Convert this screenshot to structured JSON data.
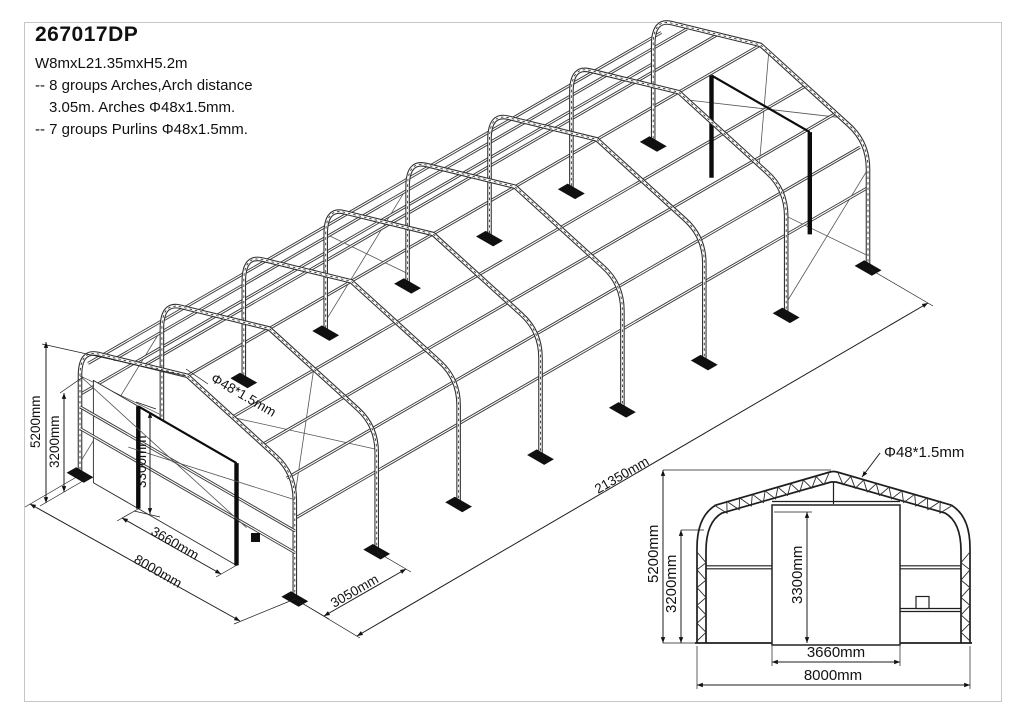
{
  "header": {
    "model": "267017DP",
    "size": "W8mxL21.35mxH5.2m",
    "spec_line1": "-- 8 groups Arches,Arch distance",
    "spec_line2": "3.05m. Arches Φ48x1.5mm.",
    "spec_line3": "-- 7 groups Purlins Φ48x1.5mm."
  },
  "iso_view": {
    "dim_height_total": "5200mm",
    "dim_wall_height": "3200mm",
    "dim_door_height": "3300mm",
    "dim_door_width": "3660mm",
    "dim_width": "8000mm",
    "dim_bay_spacing": "3050mm",
    "dim_length": "21350mm",
    "tube_label": "Φ48*1.5mm"
  },
  "front_view": {
    "dim_height_total": "5200mm",
    "dim_wall_height": "3200mm",
    "dim_door_height": "3300mm",
    "dim_door_width": "3660mm",
    "dim_width": "8000mm",
    "tube_label": "Φ48*1.5mm"
  }
}
